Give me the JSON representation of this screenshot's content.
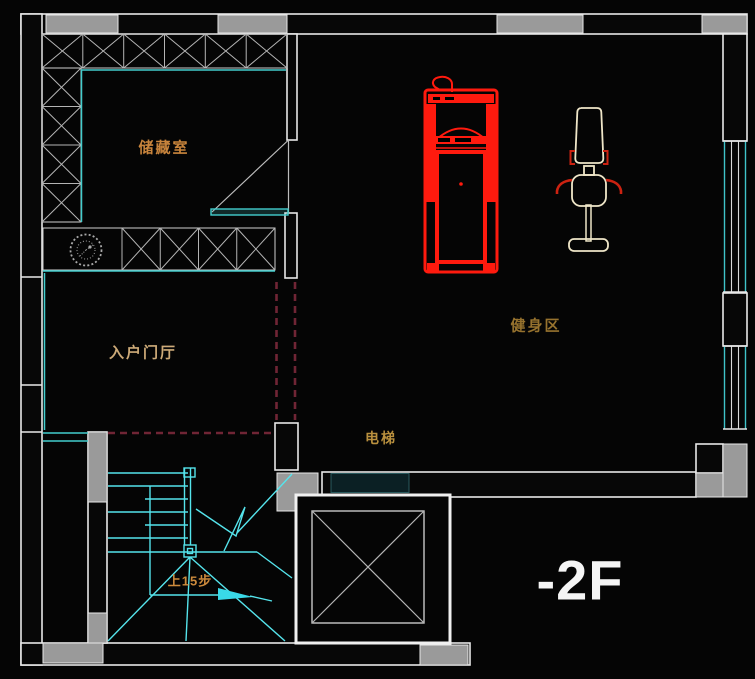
{
  "drawing": {
    "floor_label": "-2F",
    "rooms": {
      "storage": {
        "label": "储藏室"
      },
      "foyer": {
        "label": "入户门厅"
      },
      "gym": {
        "label": "健身区"
      },
      "elevator": {
        "label": "电梯"
      }
    },
    "stairs": {
      "direction_note": "上15步"
    },
    "colors": {
      "background": "#050505",
      "wall_line": "#e8e8e8",
      "wall_fill_gray": "#9a9a9a",
      "cad_teal": "#43cdcd",
      "stair_cyan": "#55e4ec",
      "equipment_red": "#ff1a0e",
      "machine_outline": "#efe6c8",
      "label_gold": "#c08a3e",
      "dashed_door_maroon": "#702535",
      "floor_text_white": "#f5f5f5"
    }
  }
}
